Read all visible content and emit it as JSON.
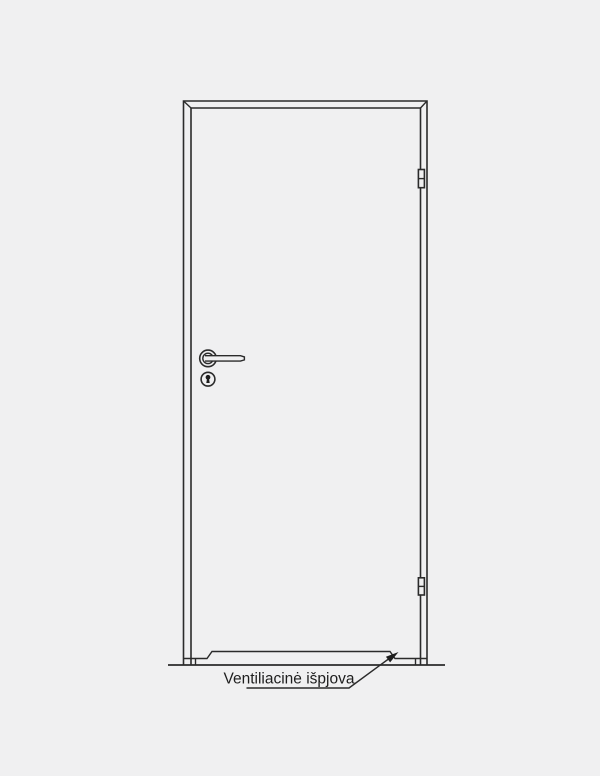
{
  "page": {
    "background_color": "#f0f0f1",
    "line_color": "#2b2b2b"
  },
  "diagram": {
    "type": "technical-line-drawing",
    "subject": "interior door front view with ventilation cutout at the bottom",
    "annotation": {
      "label": "Ventiliacinė išpjova"
    },
    "parts": [
      "door-frame",
      "door-leaf",
      "lever-handle",
      "keyhole-escutcheon",
      "top-hinge",
      "bottom-hinge",
      "ventilation-cutout",
      "floor-line",
      "leader-arrow"
    ]
  }
}
